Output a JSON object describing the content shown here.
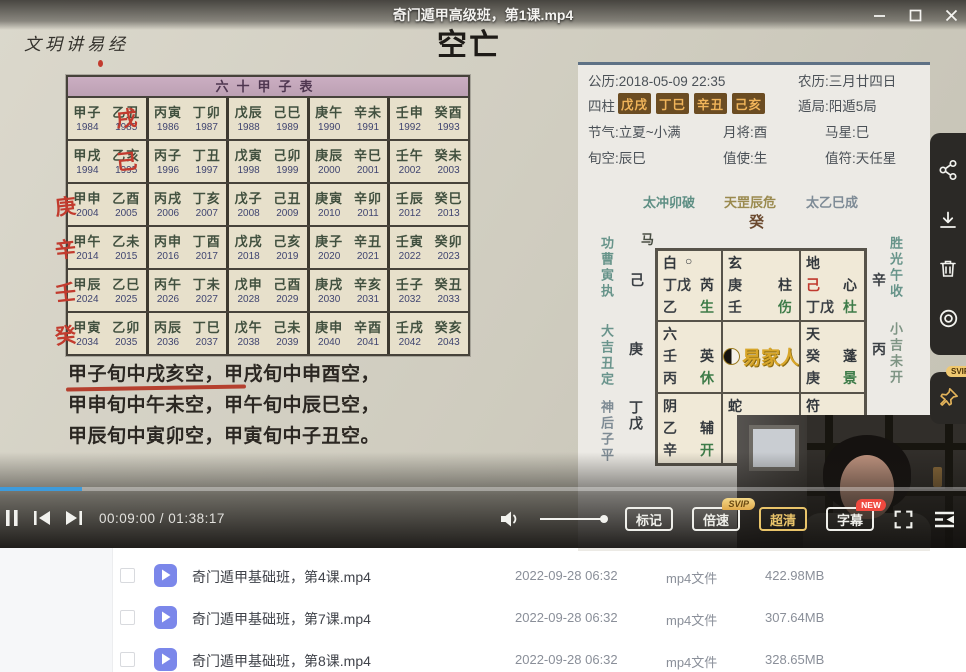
{
  "window": {
    "title": "奇门遁甲高级班，第1课.mp4"
  },
  "icons": {
    "window": [
      "minimize",
      "maximize",
      "close"
    ],
    "player": [
      "pause",
      "previous",
      "next",
      "volume",
      "fullscreen",
      "playlist"
    ],
    "side": [
      "share",
      "download",
      "trash",
      "record",
      "pin"
    ]
  },
  "video": {
    "watermark": "文玥讲易经",
    "heading": "空亡",
    "table": {
      "title": "六十甲子表",
      "rows": [
        {
          "mark": "戌",
          "mark_pos": "inner",
          "cells": [
            [
              [
                "甲子",
                "1984"
              ],
              [
                "乙丑",
                "1985"
              ]
            ],
            [
              [
                "丙寅",
                "1986"
              ],
              [
                "丁卯",
                "1987"
              ]
            ],
            [
              [
                "戊辰",
                "1988"
              ],
              [
                "己巳",
                "1989"
              ]
            ],
            [
              [
                "庚午",
                "1990"
              ],
              [
                "辛未",
                "1991"
              ]
            ],
            [
              [
                "壬申",
                "1992"
              ],
              [
                "癸酉",
                "1993"
              ]
            ]
          ]
        },
        {
          "mark": "己",
          "mark_pos": "inner",
          "cells": [
            [
              [
                "甲戌",
                "1994"
              ],
              [
                "乙亥",
                "1995"
              ]
            ],
            [
              [
                "丙子",
                "1996"
              ],
              [
                "丁丑",
                "1997"
              ]
            ],
            [
              [
                "戊寅",
                "1998"
              ],
              [
                "己卯",
                "1999"
              ]
            ],
            [
              [
                "庚辰",
                "2000"
              ],
              [
                "辛巳",
                "2001"
              ]
            ],
            [
              [
                "壬午",
                "2002"
              ],
              [
                "癸未",
                "2003"
              ]
            ]
          ]
        },
        {
          "mark": "庚",
          "mark_pos": "edge",
          "cells": [
            [
              [
                "甲申",
                "2004"
              ],
              [
                "乙酉",
                "2005"
              ]
            ],
            [
              [
                "丙戌",
                "2006"
              ],
              [
                "丁亥",
                "2007"
              ]
            ],
            [
              [
                "戊子",
                "2008"
              ],
              [
                "己丑",
                "2009"
              ]
            ],
            [
              [
                "庚寅",
                "2010"
              ],
              [
                "辛卯",
                "2011"
              ]
            ],
            [
              [
                "壬辰",
                "2012"
              ],
              [
                "癸巳",
                "2013"
              ]
            ]
          ]
        },
        {
          "mark": "辛",
          "mark_pos": "edge",
          "cells": [
            [
              [
                "甲午",
                "2014"
              ],
              [
                "乙未",
                "2015"
              ]
            ],
            [
              [
                "丙申",
                "2016"
              ],
              [
                "丁酉",
                "2017"
              ]
            ],
            [
              [
                "戊戌",
                "2018"
              ],
              [
                "己亥",
                "2019"
              ]
            ],
            [
              [
                "庚子",
                "2020"
              ],
              [
                "辛丑",
                "2021"
              ]
            ],
            [
              [
                "壬寅",
                "2022"
              ],
              [
                "癸卯",
                "2023"
              ]
            ]
          ]
        },
        {
          "mark": "壬",
          "mark_pos": "edge",
          "cells": [
            [
              [
                "甲辰",
                "2024"
              ],
              [
                "乙巳",
                "2025"
              ]
            ],
            [
              [
                "丙午",
                "2026"
              ],
              [
                "丁未",
                "2027"
              ]
            ],
            [
              [
                "戊申",
                "2028"
              ],
              [
                "己酉",
                "2029"
              ]
            ],
            [
              [
                "庚戌",
                "2030"
              ],
              [
                "辛亥",
                "2031"
              ]
            ],
            [
              [
                "壬子",
                "2032"
              ],
              [
                "癸丑",
                "2033"
              ]
            ]
          ]
        },
        {
          "mark": "癸",
          "mark_pos": "edge",
          "cells": [
            [
              [
                "甲寅",
                "2034"
              ],
              [
                "乙卯",
                "2035"
              ]
            ],
            [
              [
                "丙辰",
                "2036"
              ],
              [
                "丁巳",
                "2037"
              ]
            ],
            [
              [
                "戊午",
                "2038"
              ],
              [
                "己未",
                "2039"
              ]
            ],
            [
              [
                "庚申",
                "2040"
              ],
              [
                "辛酉",
                "2041"
              ]
            ],
            [
              [
                "壬戌",
                "2042"
              ],
              [
                "癸亥",
                "2043"
              ]
            ]
          ]
        }
      ]
    },
    "kong_lines": [
      "甲子旬中戌亥空，甲戌旬中申酉空，",
      "甲申旬中午未空，甲午旬中辰巳空，",
      "甲辰旬中寅卯空，甲寅旬中子丑空。"
    ],
    "panel": {
      "gongli": "公历:2018-05-09 22:35",
      "nongli": "农历:三月廿四日",
      "sizhu_label": "四柱",
      "pillars": [
        "戊戌",
        "丁巳",
        "辛丑",
        "己亥"
      ],
      "dunju": "遁局:阳遁5局",
      "row3": [
        "节气:立夏~小满",
        "月将:酉",
        "马星:巳"
      ],
      "row4": [
        "旬空:辰巳",
        "值使:生",
        "值符:天任星"
      ],
      "chart": {
        "top_labels": [
          "太冲卯破",
          "天罡辰危",
          "太乙巳成"
        ],
        "top_stem": "癸",
        "horse": "马",
        "left_verticals": [
          "功曹寅执",
          "大吉丑定",
          "神后子平"
        ],
        "right_verticals": [
          "胜光午收",
          "小吉未开"
        ],
        "left_stems": [
          "己",
          "庚",
          "丁戊"
        ],
        "right_stems": [
          "辛",
          "丙"
        ],
        "cells": [
          {
            "deity": "白",
            "circle": "○",
            "l2_left": "丁戊",
            "l2_right": "芮",
            "l3_left": "乙",
            "l3_right": "生"
          },
          {
            "deity": "玄",
            "l2_left": "庚",
            "l2_right": "柱",
            "l3_left": "壬",
            "l3_right": "伤"
          },
          {
            "deity": "地",
            "l2_left": "己",
            "l2_red": true,
            "l2_right": "心",
            "l3_left": "丁戊",
            "l3_right": "杜"
          },
          {
            "deity": "六",
            "l2_left": "壬",
            "l2_right": "英",
            "l3_left": "丙",
            "l3_right": "休"
          },
          {
            "logo": "易家人"
          },
          {
            "deity": "天",
            "l2_left": "癸",
            "l2_right": "蓬",
            "l3_left": "庚",
            "l3_right": "景"
          },
          {
            "deity": "阴",
            "l2_left": "乙",
            "l2_right": "辅",
            "l3_left": "辛",
            "l3_right": "开"
          },
          {
            "deity": "蛇"
          },
          {
            "deity": "符"
          }
        ]
      }
    }
  },
  "player": {
    "time": "00:09:00 / 01:38:17",
    "progress_pct": 8.5,
    "volume_pct": 100,
    "buttons": {
      "mark": "标记",
      "speed": "倍速",
      "quality": "超清",
      "subtitle": "字幕"
    },
    "badges": {
      "svip": "SVIP",
      "new": "NEW",
      "pin_svip": "SVIP"
    }
  },
  "file_list": {
    "rows": [
      {
        "name": "奇门遁甲基础班，第4课.mp4",
        "date": "2022-09-28 06:32",
        "type": "mp4文件",
        "size": "422.98MB"
      },
      {
        "name": "奇门遁甲基础班，第7课.mp4",
        "date": "2022-09-28 06:32",
        "type": "mp4文件",
        "size": "307.64MB"
      },
      {
        "name": "奇门遁甲基础班，第8课.mp4",
        "date": "2022-09-28 06:32",
        "type": "mp4文件",
        "size": "328.65MB"
      }
    ]
  },
  "colors": {
    "accent_blue": "#3E9BDB",
    "gold": "#E9C46A",
    "badge_red": "#F0493F",
    "red_mark": "#C23B2E",
    "file_icon": "#7B87EA"
  }
}
